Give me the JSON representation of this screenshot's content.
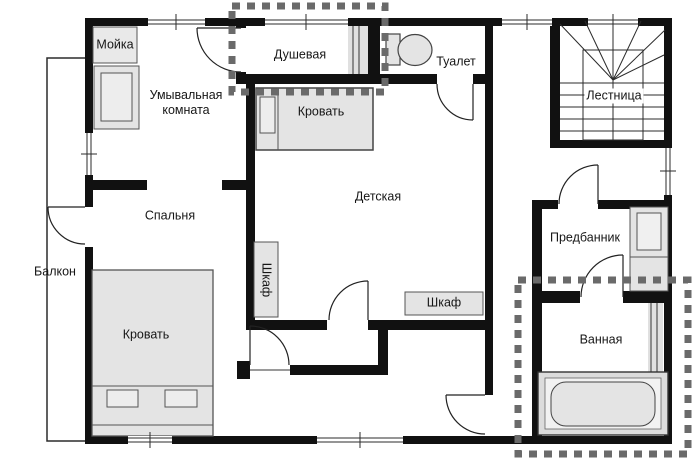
{
  "plan": {
    "colors": {
      "wall": "#111111",
      "line": "#2b2b2b",
      "furniture_fill": "#e4e4e4",
      "furniture_stroke": "#555555",
      "dotted_outline": "#6a6a6a",
      "background": "#ffffff"
    },
    "rooms": {
      "washroom": "Умывальная комната",
      "shower": "Душевая",
      "toilet": "Туалет",
      "staircase": "Лестница",
      "nursery": "Детская",
      "bedroom": "Спальня",
      "balcony": "Балкон",
      "anteroom": "Предбанник",
      "bathroom": "Ванная"
    },
    "furniture": {
      "sink": "Мойка",
      "nursery_bed": "Кровать",
      "bedroom_bed": "Кровать",
      "nursery_wardrobe": "Шкаф",
      "hall_wardrobe": "Шкаф"
    }
  }
}
